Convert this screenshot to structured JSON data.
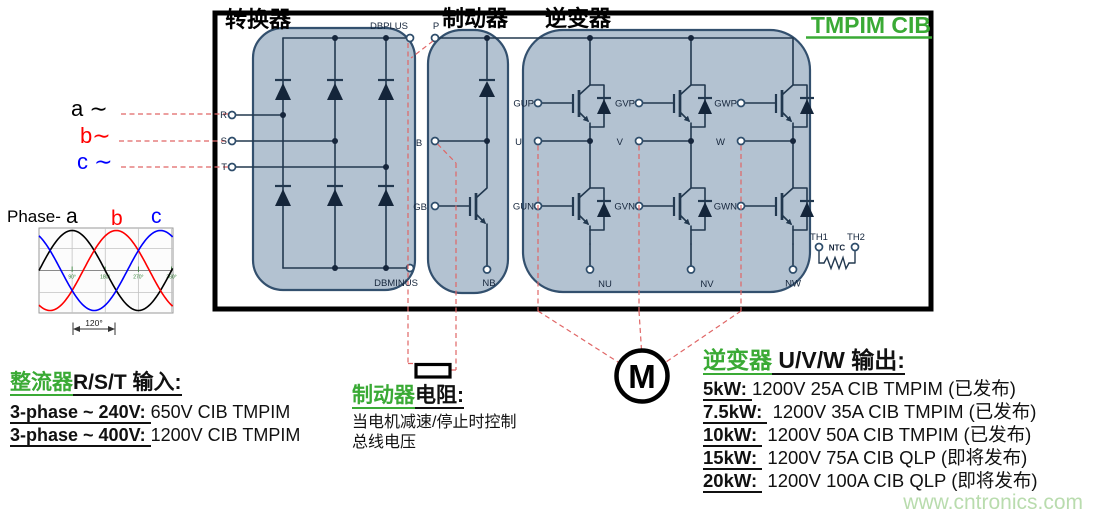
{
  "colors": {
    "green_heading": "#3aaa35",
    "module_fill": "#b3c2d1",
    "module_border": "#33506e",
    "wire": "#22384f",
    "dash_red": "#e06666",
    "phase_a": "#000000",
    "phase_b": "#ff0000",
    "phase_c": "#0000ff",
    "watermark": "#b9dcae"
  },
  "diagram": {
    "badge": "TMPIM CIB",
    "sections": {
      "converter": "转换器",
      "brake": "制动器",
      "inverter": "逆变器"
    },
    "terminals": {
      "dbplus": "DBPLUS",
      "p": "P",
      "dbminus": "DBMINUS",
      "nb": "NB",
      "r": "R",
      "s": "S",
      "t": "T",
      "b": "B",
      "gb": "GB",
      "gup": "GUP",
      "gvp": "GVP",
      "gwp": "GWP",
      "u": "U",
      "v": "V",
      "w": "W",
      "gun": "GUN",
      "gvn": "GVN",
      "gwn": "GWN",
      "nu": "NU",
      "nv": "NV",
      "nw": "NW",
      "th1": "TH1",
      "th2": "TH2",
      "ntc": "NTC"
    },
    "motor_label": "M"
  },
  "phase_inputs": {
    "a": "a ∼",
    "b": "b∼",
    "c": "c ∼"
  },
  "chart_data": {
    "type": "line",
    "title": "Phase-",
    "series": [
      {
        "name": "a",
        "color": "#000000",
        "phase_deg": 0
      },
      {
        "name": "b",
        "color": "#ff0000",
        "phase_deg": -120
      },
      {
        "name": "c",
        "color": "#0000ff",
        "phase_deg": 120
      }
    ],
    "x_ticks": [
      "90°",
      "180°",
      "270°",
      "360°"
    ],
    "x_tick_deg": [
      90,
      180,
      270,
      360
    ],
    "x_range_deg": [
      0,
      363
    ],
    "amplitude": 1,
    "grid": true,
    "annotation": "120°"
  },
  "rectifier_note": {
    "heading_green": "整流器",
    "heading_black": "R/S/T 输入:",
    "lines": [
      {
        "prefix": "3-phase ~ 240V: ",
        "rest": "650V CIB TMPIM"
      },
      {
        "prefix": "3-phase ~ 400V: ",
        "rest": "1200V CIB TMPIM"
      }
    ]
  },
  "brake_note": {
    "heading_green": "制动器",
    "heading_black": "电阻:",
    "body": "当电机减速/停止时控制总线电压"
  },
  "inverter_note": {
    "heading_green": "逆变器",
    "heading_black": " U/V/W 输出:",
    "items": [
      {
        "prefix": "5kW: ",
        "rest": "1200V 25A CIB TMPIM (已发布)"
      },
      {
        "prefix": "7.5kW: ",
        "rest": " 1200V 35A CIB TMPIM (已发布)"
      },
      {
        "prefix": "10kW: ",
        "rest": " 1200V 50A CIB TMPIM (已发布)"
      },
      {
        "prefix": "15kW: ",
        "rest": " 1200V 75A CIB QLP (即将发布)"
      },
      {
        "prefix": "20kW: ",
        "rest": " 1200V 100A CIB QLP (即将发布)"
      }
    ]
  },
  "watermark": "www.cntronics.com"
}
